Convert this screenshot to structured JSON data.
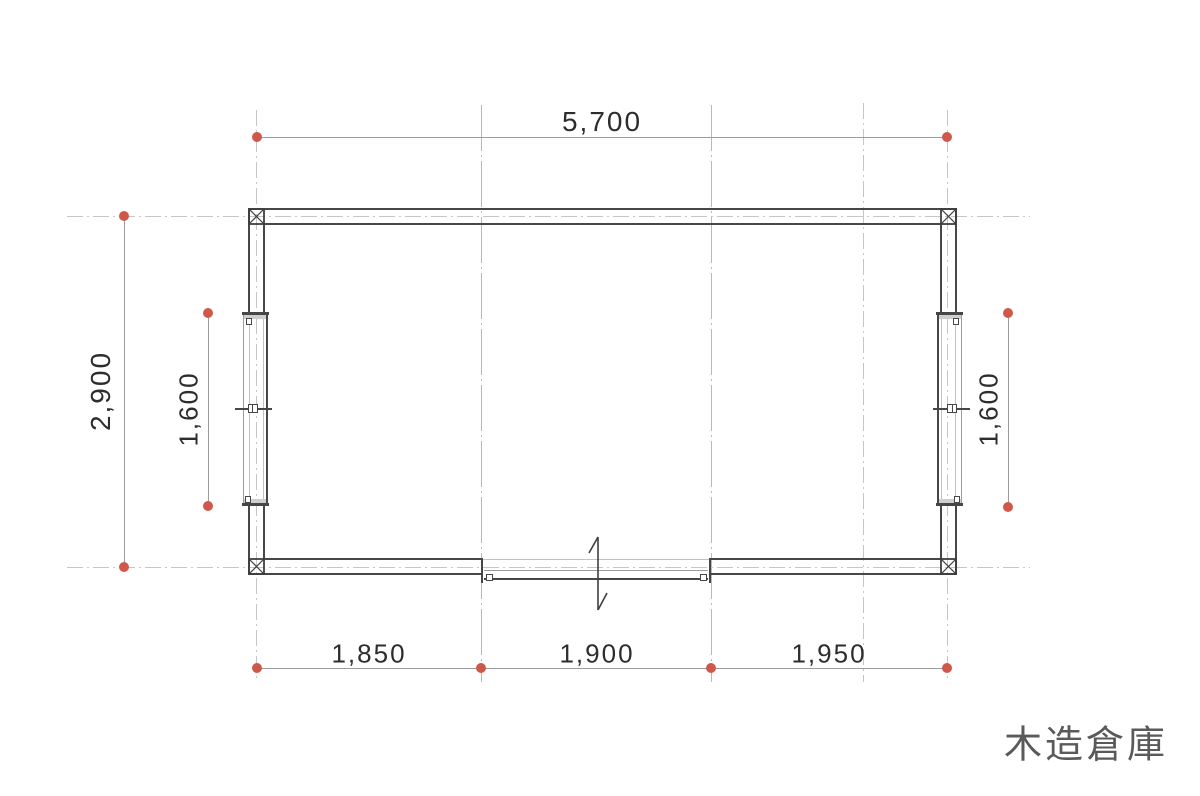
{
  "title": "木造倉庫",
  "dimensions": {
    "top": "5,700",
    "left": "2,900",
    "window_left": "1,600",
    "window_right": "1,600",
    "bottom": [
      "1,850",
      "1,900",
      "1,950"
    ]
  },
  "plan": {
    "overall_width_mm": 5700,
    "overall_depth_mm": 2900,
    "bottom_bays_mm": [
      1850,
      1900,
      1950
    ],
    "side_window_length_mm": 1600
  },
  "colors": {
    "wall_line": "#474747",
    "grid_line": "#c6c6c6",
    "dimension_line": "#9c9c9c",
    "marker_red": "#d0584a",
    "dimension_text": "#2d2d2d",
    "title_text": "#5a5a5a"
  }
}
